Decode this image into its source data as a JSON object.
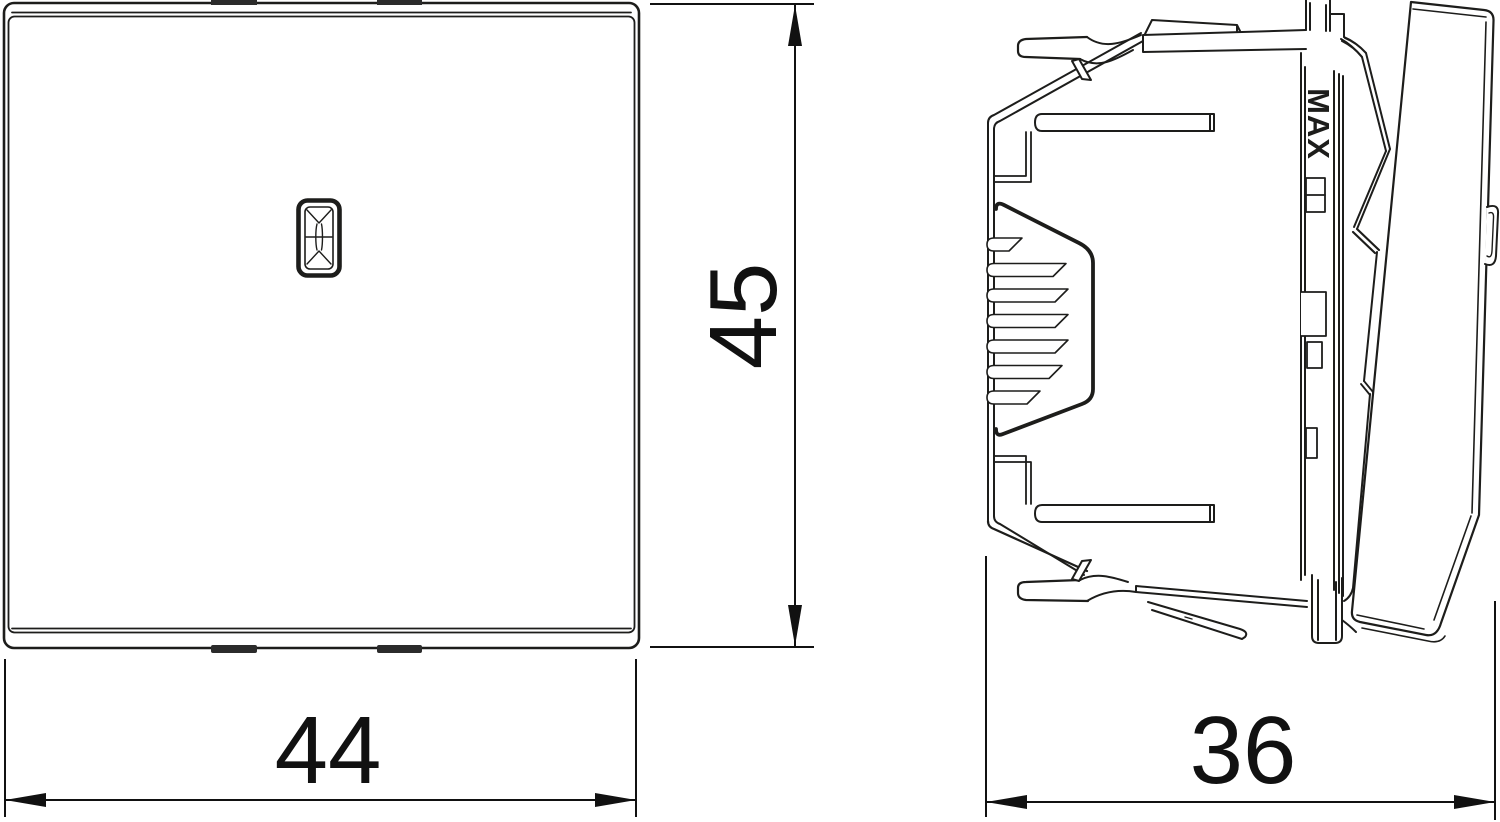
{
  "drawing": {
    "kind": "technical dimension drawing",
    "background_color": "#ffffff",
    "line_color": "#1d1d1b",
    "dimension_color": "#111111",
    "views": {
      "front": {
        "name": "front view of switch rocker plate"
      },
      "side": {
        "name": "side view of switch mechanism with paddle"
      }
    },
    "labels": {
      "max": "MAX"
    },
    "dimensions": {
      "width": {
        "value": "44",
        "orientation": "horizontal",
        "view": "front"
      },
      "height": {
        "value": "45",
        "orientation": "vertical",
        "view": "front"
      },
      "depth": {
        "value": "36",
        "orientation": "horizontal",
        "view": "side"
      }
    }
  }
}
